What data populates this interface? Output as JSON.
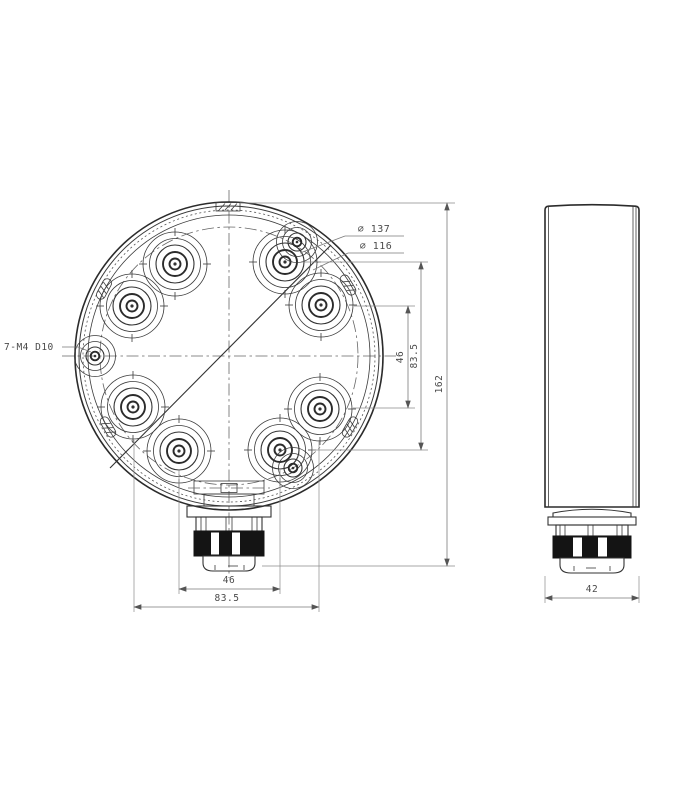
{
  "drawing": {
    "labels": {
      "thread_callout": "7-M4 D10",
      "dia_outer": "⌀ 137",
      "dia_bolt": "⌀ 116"
    },
    "dims": {
      "v_small": "46",
      "v_large": "83.5",
      "overall_h": "162",
      "h_small": "46",
      "h_large": "83.5",
      "side_w": "42"
    },
    "colors": {
      "line": "#2f2f2f",
      "dim_line": "#7a7a7a",
      "text": "#4a4a4a",
      "fill_dark": "#141414",
      "background": "#ffffff"
    }
  }
}
